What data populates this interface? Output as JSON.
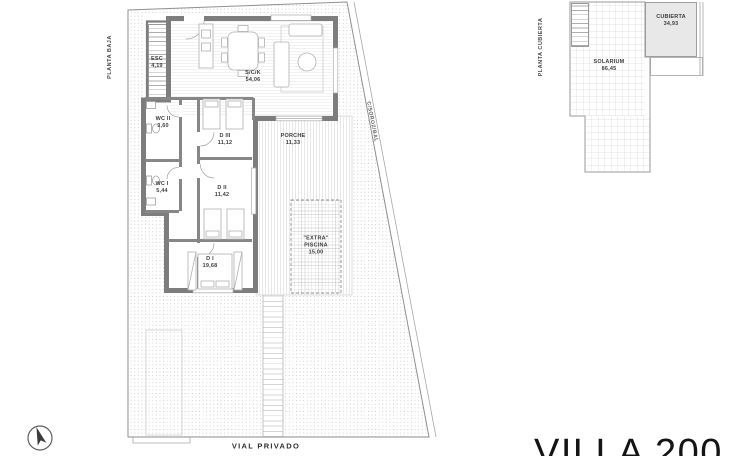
{
  "title": "VILLA 200",
  "ground_floor": {
    "plan_label": "PLANTA BAJA",
    "street_label": "C/SOROZ/BAL",
    "road_label": "VIAL PRIVADO",
    "rooms": [
      {
        "id": "esc",
        "label": "ESC",
        "area": "4,19"
      },
      {
        "id": "sck",
        "label": "S/C/K",
        "area": "54,06"
      },
      {
        "id": "wc2",
        "label": "WC II",
        "area": "3,60"
      },
      {
        "id": "d3",
        "label": "D III",
        "area": "11,12"
      },
      {
        "id": "porche",
        "label": "PORCHE",
        "area": "11,33"
      },
      {
        "id": "wc1",
        "label": "WC I",
        "area": "5,44"
      },
      {
        "id": "d2",
        "label": "D II",
        "area": "11,42"
      },
      {
        "id": "d1",
        "label": "D I",
        "area": "19,68"
      },
      {
        "id": "piscina",
        "quote_label": "\"EXTRA\"",
        "label": "PISCINA",
        "area": "15,00"
      }
    ]
  },
  "roof_floor": {
    "plan_label": "PLANTA CUBIERTA",
    "rooms": [
      {
        "id": "solarium",
        "label": "SOLARIUM",
        "area": "86,45"
      },
      {
        "id": "cubierta",
        "label": "CUBIERTA",
        "area": "34,93"
      }
    ]
  },
  "icons": {
    "compass": "north-arrow"
  },
  "colors": {
    "wall": "#7d7d7d",
    "thin_line": "#9a9a9a",
    "roof_fill": "#e8e8e8",
    "text": "#3e3e3e"
  }
}
